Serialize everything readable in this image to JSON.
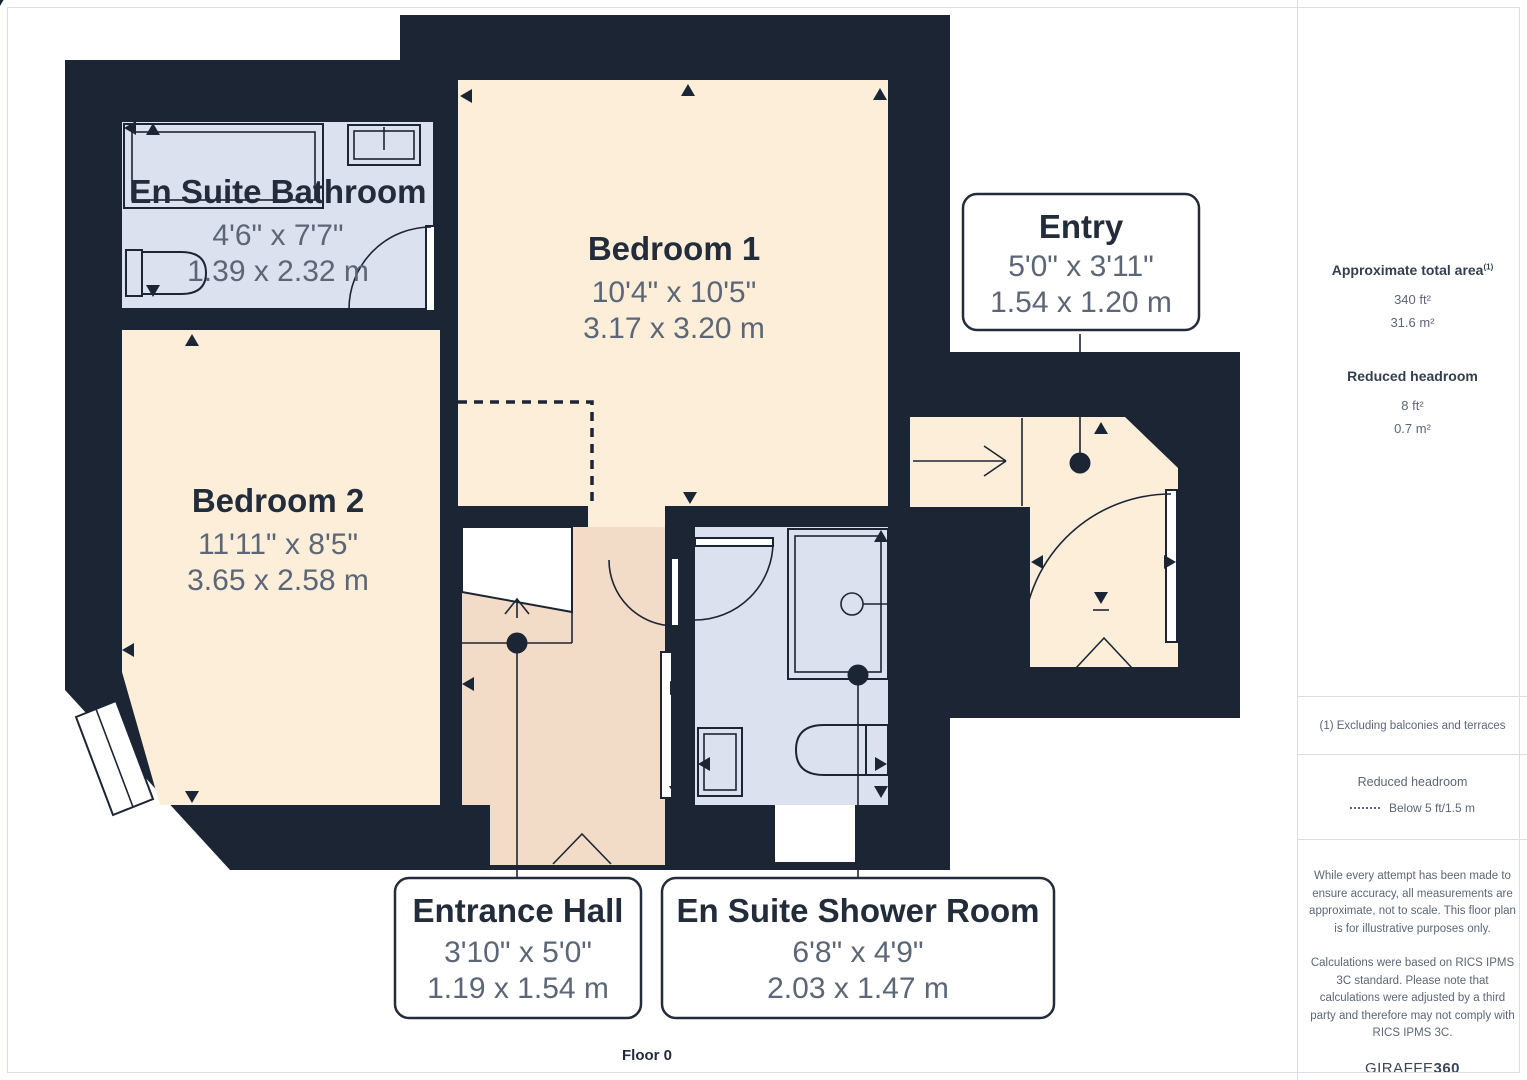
{
  "floorplan": {
    "floor_label": "Floor 0",
    "rooms": [
      {
        "name": "En Suite Bathroom",
        "dims_ft": "4'6\" x 7'7\"",
        "dims_m": "1.39 x 2.32 m"
      },
      {
        "name": "Bedroom 1",
        "dims_ft": "10'4\" x 10'5\"",
        "dims_m": "3.17 x 3.20 m"
      },
      {
        "name": "Bedroom 2",
        "dims_ft": "11'11\" x 8'5\"",
        "dims_m": "3.65 x 2.58 m"
      },
      {
        "name": "Entry",
        "dims_ft": "5'0\" x 3'11\"",
        "dims_m": "1.54 x 1.20 m"
      },
      {
        "name": "Entrance Hall",
        "dims_ft": "3'10\" x 5'0\"",
        "dims_m": "1.19 x 1.54 m"
      },
      {
        "name": "En Suite Shower Room",
        "dims_ft": "6'8\" x 4'9\"",
        "dims_m": "2.03 x 1.47 m"
      }
    ]
  },
  "sidebar": {
    "total_area_label": "Approximate total area",
    "total_area_superscript": "(1)",
    "total_area_ft": "340 ft²",
    "total_area_m": "31.6 m²",
    "reduced_headroom_label": "Reduced headroom",
    "reduced_headroom_ft": "8 ft²",
    "reduced_headroom_m": "0.7 m²",
    "footnote": "(1) Excluding balconies and terraces",
    "legend_title": "Reduced headroom",
    "legend_item": "Below 5 ft/1.5 m",
    "disclaimer1": "While every attempt has been made to ensure accuracy, all measurements are approximate, not to scale. This floor plan is for illustrative purposes only.",
    "disclaimer2": "Calculations were based on RICS IPMS 3C standard. Please note that calculations were adjusted by a third party and therefore may not comply with RICS IPMS 3C.",
    "brand_name": "GIRAFFE",
    "brand_suffix": "360"
  },
  "theme": {
    "wall": "#1c2534",
    "room_cream": "#fdeeda",
    "room_blue": "#dbe1ee",
    "room_peach": "#f3dcc7",
    "text_dark": "#232c3a",
    "text_gray": "#5c6677",
    "border": "#dadde2"
  }
}
